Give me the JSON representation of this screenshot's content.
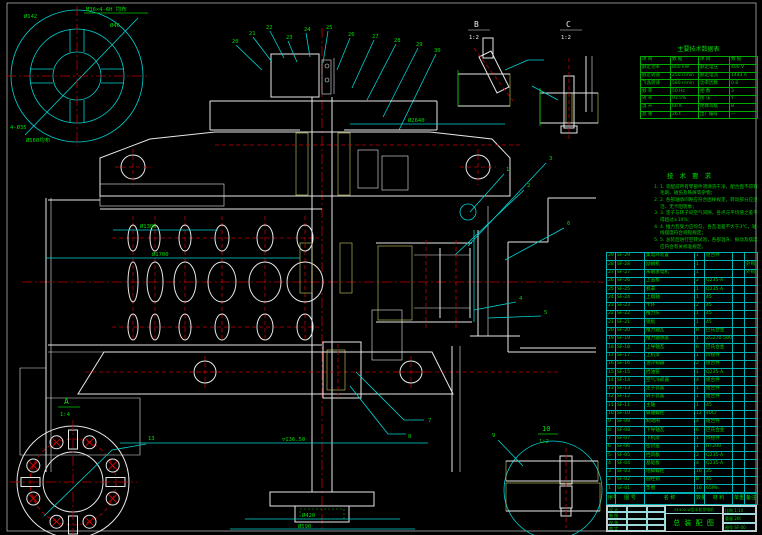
{
  "colors": {
    "background": "#000000",
    "outline": "#e8e8e8",
    "centerline": "#c40000",
    "auxiliary": "#00d4d4",
    "annotation": "#00dd00",
    "hatch": "#d8d84a"
  },
  "spec_table": {
    "title": "主要技术数据表",
    "rows": [
      [
        "项 目",
        "数 据",
        "项 目",
        "数 据"
      ],
      [
        "额定功率",
        "800 kW",
        "额定电压",
        "400 V"
      ],
      [
        "额定转速",
        "250 r/min",
        "额定电流",
        "1443 A"
      ],
      [
        "飞逸转速",
        "580 r/min",
        "功率因数",
        "0.8"
      ],
      [
        "频 率",
        "50 Hz",
        "相 数",
        "3"
      ],
      [
        "效 率",
        "93.5%",
        "接 法",
        "Y"
      ],
      [
        "温 升",
        "60 K",
        "绝缘等级",
        "B"
      ],
      [
        "总 重",
        "26 t",
        "出厂编号",
        "—"
      ]
    ]
  },
  "tech_notes": {
    "title": "技 术 要 求",
    "items": [
      "1. 装配前所有零部件须清洗干净，配合面不得有毛刺、碰伤及铁屑等杂物；",
      "2. 各部轴承间隙应符合图样规定，转动部分应灵活、无卡阻现象；",
      "3. 定子与转子间空气间隙，各点与平均值之差不得超过±10%；",
      "4. 推力瓦受力应均匀，各瓦温差不大于3℃，轴线摆度符合规程规定；",
      "5. 总装后进行空转试验，各部温升、振动及摆度应符合有关标准规定。"
    ]
  },
  "parts_list": {
    "header": [
      "序号",
      "图 号",
      "名 称",
      "数量",
      "材 料",
      "单重",
      "备注"
    ],
    "rows": [
      [
        "29",
        "SF-29",
        "集电环装置",
        "1",
        "组合件",
        "",
        ""
      ],
      [
        "28",
        "SF-28",
        "励磁机",
        "1",
        "",
        "",
        "外购"
      ],
      [
        "27",
        "SF-27",
        "永磁发电机",
        "1",
        "",
        "",
        "外购"
      ],
      [
        "26",
        "SF-26",
        "上盖板",
        "2",
        "Q235-A",
        "",
        ""
      ],
      [
        "25",
        "SF-25",
        "机罩",
        "1",
        "Q235-A",
        "",
        ""
      ],
      [
        "24",
        "SF-24",
        "上端轴",
        "1",
        "45",
        "",
        ""
      ],
      [
        "23",
        "SF-23",
        "卡环",
        "2",
        "45",
        "",
        ""
      ],
      [
        "22",
        "SF-22",
        "推力头",
        "1",
        "45",
        "",
        ""
      ],
      [
        "21",
        "SF-21",
        "镜板",
        "1",
        "45",
        "",
        ""
      ],
      [
        "20",
        "SF-20",
        "推力轴瓦",
        "8",
        "巴氏合金",
        "",
        ""
      ],
      [
        "19",
        "SF-19",
        "推力轴承座",
        "1",
        "ZG270-500",
        "",
        ""
      ],
      [
        "18",
        "SF-18",
        "上导轴瓦",
        "6",
        "巴氏合金",
        "",
        ""
      ],
      [
        "17",
        "SF-17",
        "上机架",
        "1",
        "焊接件",
        "",
        ""
      ],
      [
        "16",
        "SF-16",
        "油冷却器",
        "2",
        "组合件",
        "",
        ""
      ],
      [
        "15",
        "SF-15",
        "挡油管",
        "1",
        "Q235-A",
        "",
        ""
      ],
      [
        "14",
        "SF-14",
        "空气冷却器",
        "4",
        "组合件",
        "",
        ""
      ],
      [
        "13",
        "SF-13",
        "定子装置",
        "1",
        "组合件",
        "",
        ""
      ],
      [
        "12",
        "SF-12",
        "转子装置",
        "1",
        "组合件",
        "",
        ""
      ],
      [
        "11",
        "SF-11",
        "主轴",
        "1",
        "45",
        "",
        ""
      ],
      [
        "10",
        "SF-10",
        "联轴螺栓",
        "12",
        "40Cr",
        "",
        ""
      ],
      [
        "9",
        "SF-09",
        "制动闸",
        "4",
        "组合件",
        "",
        ""
      ],
      [
        "8",
        "SF-08",
        "下导轴瓦",
        "6",
        "巴氏合金",
        "",
        ""
      ],
      [
        "7",
        "SF-07",
        "下机架",
        "1",
        "焊接件",
        "",
        ""
      ],
      [
        "6",
        "SF-06",
        "密封盖",
        "1",
        "HT200",
        "",
        ""
      ],
      [
        "5",
        "SF-05",
        "挡风板",
        "2",
        "Q235-A",
        "",
        ""
      ],
      [
        "4",
        "SF-04",
        "基础板",
        "4",
        "Q235-A",
        "",
        ""
      ],
      [
        "3",
        "SF-03",
        "地脚螺栓",
        "16",
        "35",
        "",
        ""
      ],
      [
        "2",
        "SF-02",
        "圆柱销",
        "8",
        "45",
        "",
        ""
      ],
      [
        "1",
        "SF-01",
        "垫圈",
        "16",
        "65Mn",
        "",
        ""
      ]
    ]
  },
  "title_block": {
    "station": "SF400-W型水轮发电机",
    "title": "总 装 配 图",
    "scale_label": "比例",
    "scale": "1:10",
    "weight_label": "重量",
    "weight": "26t",
    "dwg_no_label": "图号",
    "dwg_no": "SF-00",
    "sign_rows": [
      [
        "设 计",
        "",
        ""
      ],
      [
        "制 图",
        "",
        ""
      ],
      [
        "校 核",
        "",
        ""
      ],
      [
        "审 定",
        "",
        ""
      ]
    ]
  },
  "annotations": [
    {
      "x": 24,
      "y": 18,
      "t": "Ø142"
    },
    {
      "x": 86,
      "y": 11,
      "t": "M36×4-6H 均布"
    },
    {
      "x": 110,
      "y": 27,
      "t": "Ø46"
    },
    {
      "x": 10,
      "y": 129,
      "t": "4-Ø35"
    },
    {
      "x": 26,
      "y": 142,
      "t": "Ø560均布"
    },
    {
      "x": 232,
      "y": 43,
      "t": "20"
    },
    {
      "x": 249,
      "y": 35,
      "t": "21"
    },
    {
      "x": 266,
      "y": 29,
      "t": "22"
    },
    {
      "x": 286,
      "y": 39,
      "t": "23"
    },
    {
      "x": 304,
      "y": 31,
      "t": "24"
    },
    {
      "x": 326,
      "y": 29,
      "t": "25"
    },
    {
      "x": 348,
      "y": 36,
      "t": "26"
    },
    {
      "x": 372,
      "y": 38,
      "t": "27"
    },
    {
      "x": 394,
      "y": 42,
      "t": "28"
    },
    {
      "x": 416,
      "y": 46,
      "t": "29"
    },
    {
      "x": 434,
      "y": 52,
      "t": "30"
    },
    {
      "x": 506,
      "y": 171,
      "t": "1"
    },
    {
      "x": 527,
      "y": 187,
      "t": "2"
    },
    {
      "x": 549,
      "y": 160,
      "t": "3"
    },
    {
      "x": 519,
      "y": 300,
      "t": "4"
    },
    {
      "x": 544,
      "y": 314,
      "t": "5"
    },
    {
      "x": 567,
      "y": 225,
      "t": "6"
    },
    {
      "x": 428,
      "y": 422,
      "t": "7"
    },
    {
      "x": 408,
      "y": 438,
      "t": "8"
    },
    {
      "x": 492,
      "y": 437,
      "t": "9"
    },
    {
      "x": 148,
      "y": 440,
      "t": "13"
    },
    {
      "x": 152,
      "y": 256,
      "t": "Ø1700"
    },
    {
      "x": 140,
      "y": 228,
      "t": "Ø1300"
    },
    {
      "x": 282,
      "y": 441,
      "t": "▽136.50"
    },
    {
      "x": 302,
      "y": 517,
      "t": "Ø420"
    },
    {
      "x": 298,
      "y": 528,
      "t": "Ø590"
    },
    {
      "x": 408,
      "y": 122,
      "t": "Ø2640"
    },
    {
      "x": 64,
      "y": 404,
      "t": "A",
      "s": 8
    },
    {
      "x": 60,
      "y": 416,
      "t": "1:4"
    },
    {
      "x": 542,
      "y": 431,
      "t": "10",
      "s": 7
    },
    {
      "x": 539,
      "y": 443,
      "t": "1:2"
    },
    {
      "x": 474,
      "y": 27,
      "t": "B",
      "s": 8,
      "c": "w"
    },
    {
      "x": 469,
      "y": 39,
      "t": "1:2",
      "c": "w"
    },
    {
      "x": 566,
      "y": 27,
      "t": "C",
      "s": 8,
      "c": "w"
    },
    {
      "x": 561,
      "y": 39,
      "t": "1:2",
      "c": "w"
    }
  ]
}
